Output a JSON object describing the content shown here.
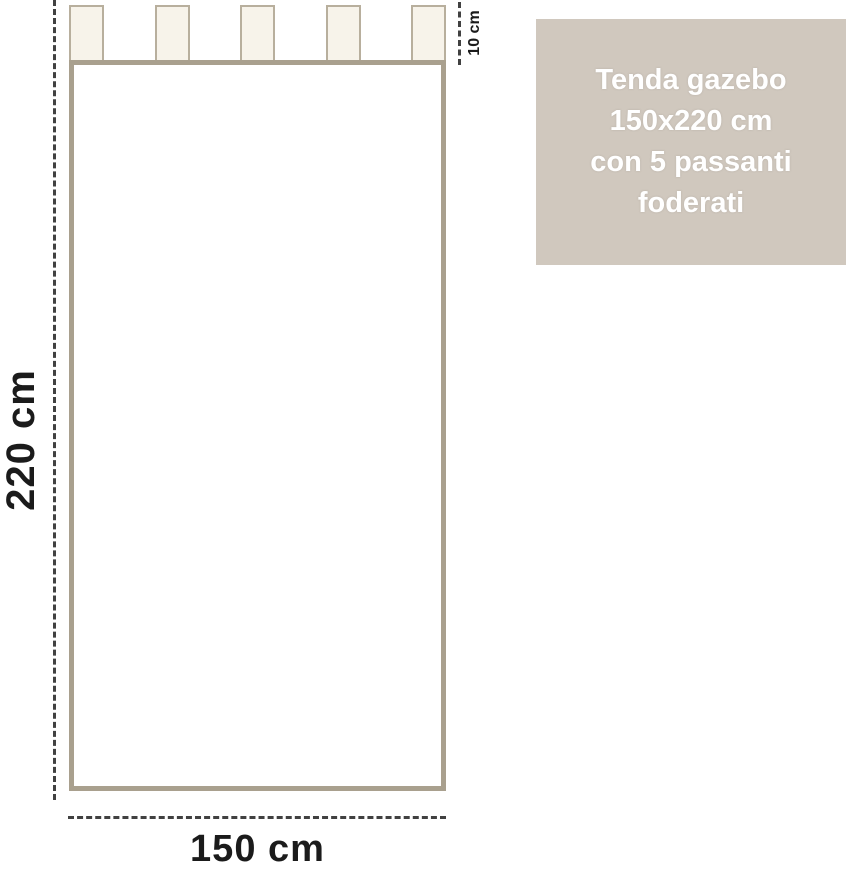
{
  "info_box": {
    "lines": [
      "Tenda gazebo",
      "150x220 cm",
      "con 5 passanti",
      "foderati"
    ]
  },
  "dimensions": {
    "height_label": "220 cm",
    "width_label": "150 cm",
    "tab_label": "10 cm"
  },
  "diagram": {
    "tab_count": 5
  },
  "colors": {
    "curtain_border": "#a9a08e",
    "tab_fill": "#f7f3ea",
    "tab_border": "#b8af9d",
    "info_box_bg": "#d0c8be",
    "info_box_text": "#ffffff",
    "dash": "#414141",
    "dimension_text": "#1b1b1b"
  }
}
